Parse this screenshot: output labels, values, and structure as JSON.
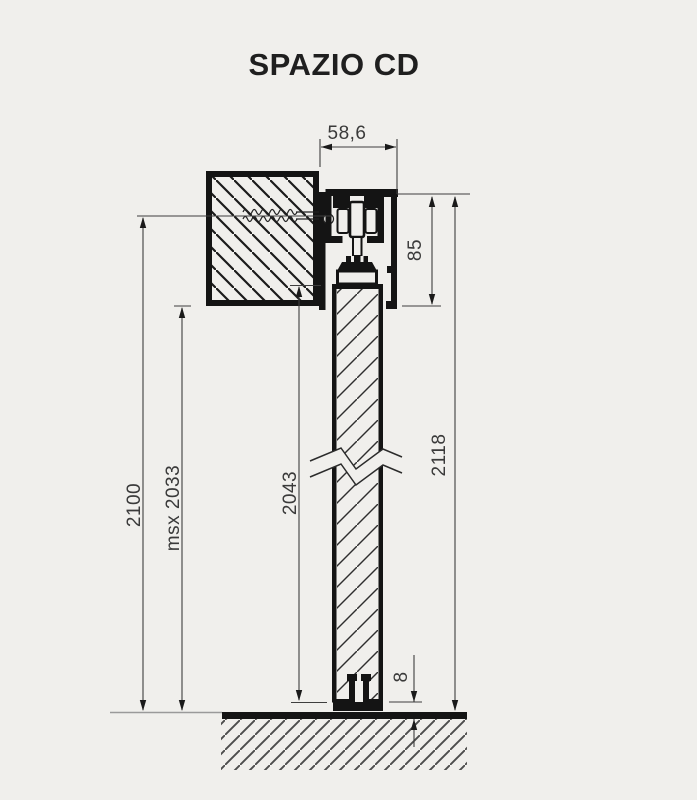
{
  "title": "SPAZIO CD",
  "colors": {
    "background": "#f0efec",
    "line": "#141414",
    "dimension": "#3a3a3a",
    "thin_floor": "#9a9a9a"
  },
  "dimensions": {
    "system_depth": "58,6",
    "header_height": "85",
    "overall_height": "2118",
    "installation_height": "2100",
    "max_passage": "msx 2033",
    "door_panel_height": "2043",
    "floor_clearance": "8"
  }
}
